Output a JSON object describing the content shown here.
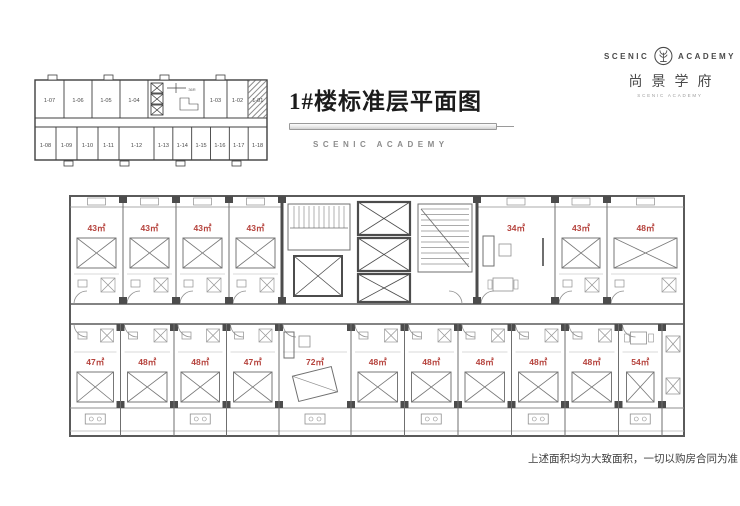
{
  "header": {
    "title": "1#楼标准层平面图",
    "subtitle": "SCENIC ACADEMY"
  },
  "logo": {
    "name_left": "SCENIC",
    "name_right": "ACADEMY",
    "chinese_name": "尚景学府",
    "tagline": "SCENIC ACADEMY"
  },
  "keyplan": {
    "top_units": [
      "1-07",
      "1-06",
      "1-05",
      "1-04",
      "1-03",
      "1-02",
      "1-01"
    ],
    "bottom_units": [
      "1-08",
      "1-09",
      "1-10",
      "1-11",
      "1-12",
      "1-13",
      "1-14",
      "1-15",
      "1-16",
      "1-17",
      "1-18"
    ],
    "stair_label": "36R"
  },
  "plan": {
    "area_label_color": "#b5423c",
    "top_rooms": [
      "43㎡",
      "43㎡",
      "43㎡",
      "43㎡",
      "34㎡",
      "43㎡",
      "48㎡"
    ],
    "bottom_rooms": [
      "47㎡",
      "48㎡",
      "48㎡",
      "47㎡",
      "72㎡",
      "48㎡",
      "48㎡",
      "48㎡",
      "48㎡",
      "48㎡",
      "54㎡"
    ]
  },
  "footer": {
    "disclaimer": "上述面积均为大致面积，一切以购房合同为准"
  }
}
